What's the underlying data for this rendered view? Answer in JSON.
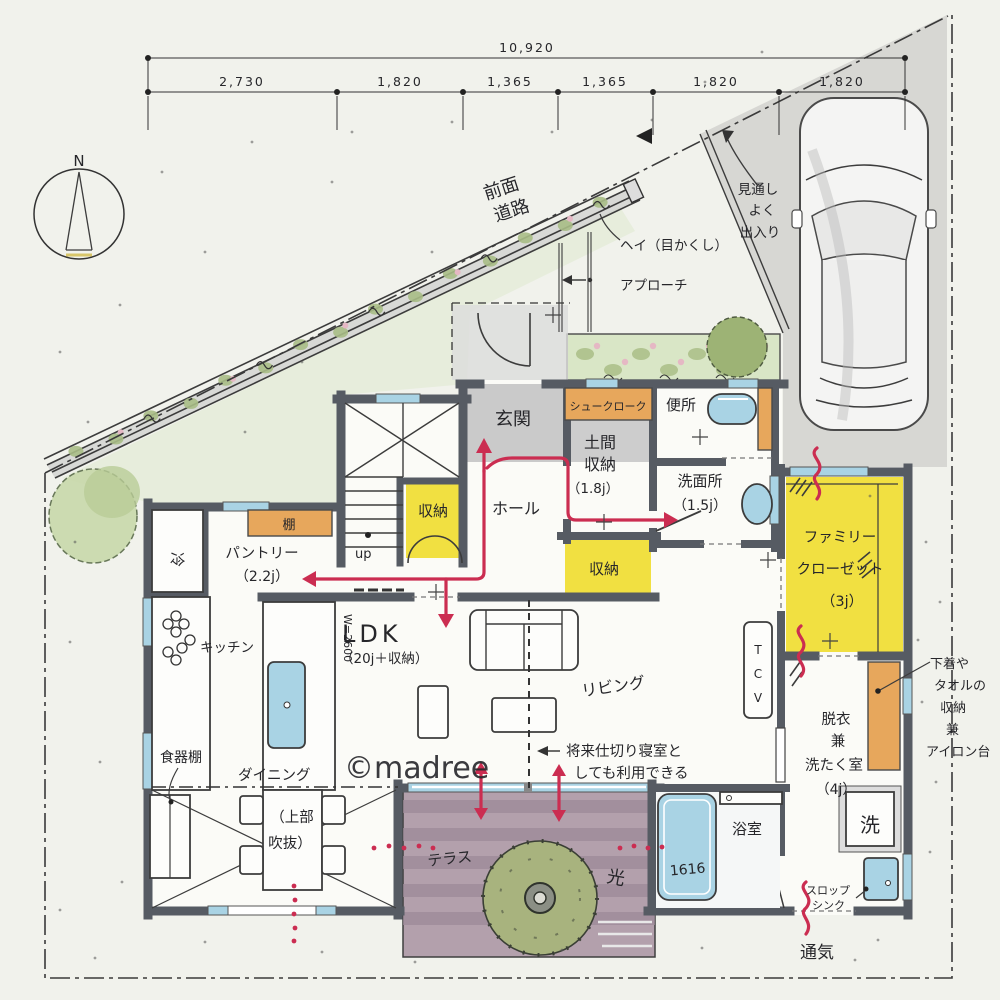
{
  "compass": {
    "north": "N"
  },
  "dimensions": {
    "total": "10,920",
    "segments": [
      "2,730",
      "1,820",
      "1,365",
      "1,365",
      "1,820",
      "1,820"
    ]
  },
  "site": {
    "road_line1": "前面",
    "road_line2": "道路",
    "fence_label": "ヘイ（目かくし）",
    "approach_label": "アプローチ",
    "visibility_line1": "見通し",
    "visibility_line2": "よく",
    "visibility_line3": "出入り"
  },
  "rooms": {
    "genkan": "玄関",
    "hall": "ホール",
    "shoe_cloak": "シュークローク",
    "doma_line1": "土間",
    "doma_line2": "収納",
    "doma_size": "（1.8j）",
    "toilet": "便所",
    "washroom": "洗面所",
    "washroom_size": "（1.5j）",
    "understair_storage": "収納",
    "hall_storage": "収納",
    "family_closet_line1": "ファミリー",
    "family_closet_line2": "クローゼット",
    "family_closet_size": "（3j）",
    "ldk": "LDK",
    "ldk_size": "（20j＋収納）",
    "kitchen": "キッチン",
    "pantry": "パントリー",
    "pantry_size": "（2.2j）",
    "fridge": "冷",
    "shelf": "棚",
    "dish_cabinet": "食器棚",
    "dining": "ダイニング",
    "void_line1": "（上部",
    "void_line2": "吹抜）",
    "living": "リビング",
    "terrace": "テラス",
    "bathroom": "浴室",
    "bathtub": "1616",
    "laundry_line1": "脱衣",
    "laundry_line2": "兼",
    "laundry_line3": "洗たく室",
    "laundry_size": "（4j）",
    "washer": "洗",
    "slop_line1": "スロップ",
    "slop_line2": "シンク",
    "stairs_up": "up",
    "island_width": "W=2600",
    "tv_l1": "T",
    "tv_l2": "C",
    "tv_l3": "V"
  },
  "annotations": {
    "future_line1": "将来仕切り寝室と",
    "future_line2": "しても利用できる",
    "closet_note_line1": "下着や",
    "closet_note_line2": "タオルの",
    "closet_note_line3": "収納",
    "closet_note_line4": "兼",
    "closet_note_line5": "アイロン台",
    "vent": "通気",
    "light": "光",
    "watermark": "©madree"
  },
  "colors": {
    "wall": "#565b63",
    "yellow": "#f1e041",
    "orange": "#e7a75c",
    "fixture_blue": "#a9d3e4",
    "terrace": "#b3a0ac",
    "red": "#cb2d51",
    "floor_gray": "#cacaca",
    "driveway": "#d2d2cf",
    "green_light": "#dfe9cf",
    "hedge": "#a9bd86",
    "paper": "#f1f2ec"
  }
}
